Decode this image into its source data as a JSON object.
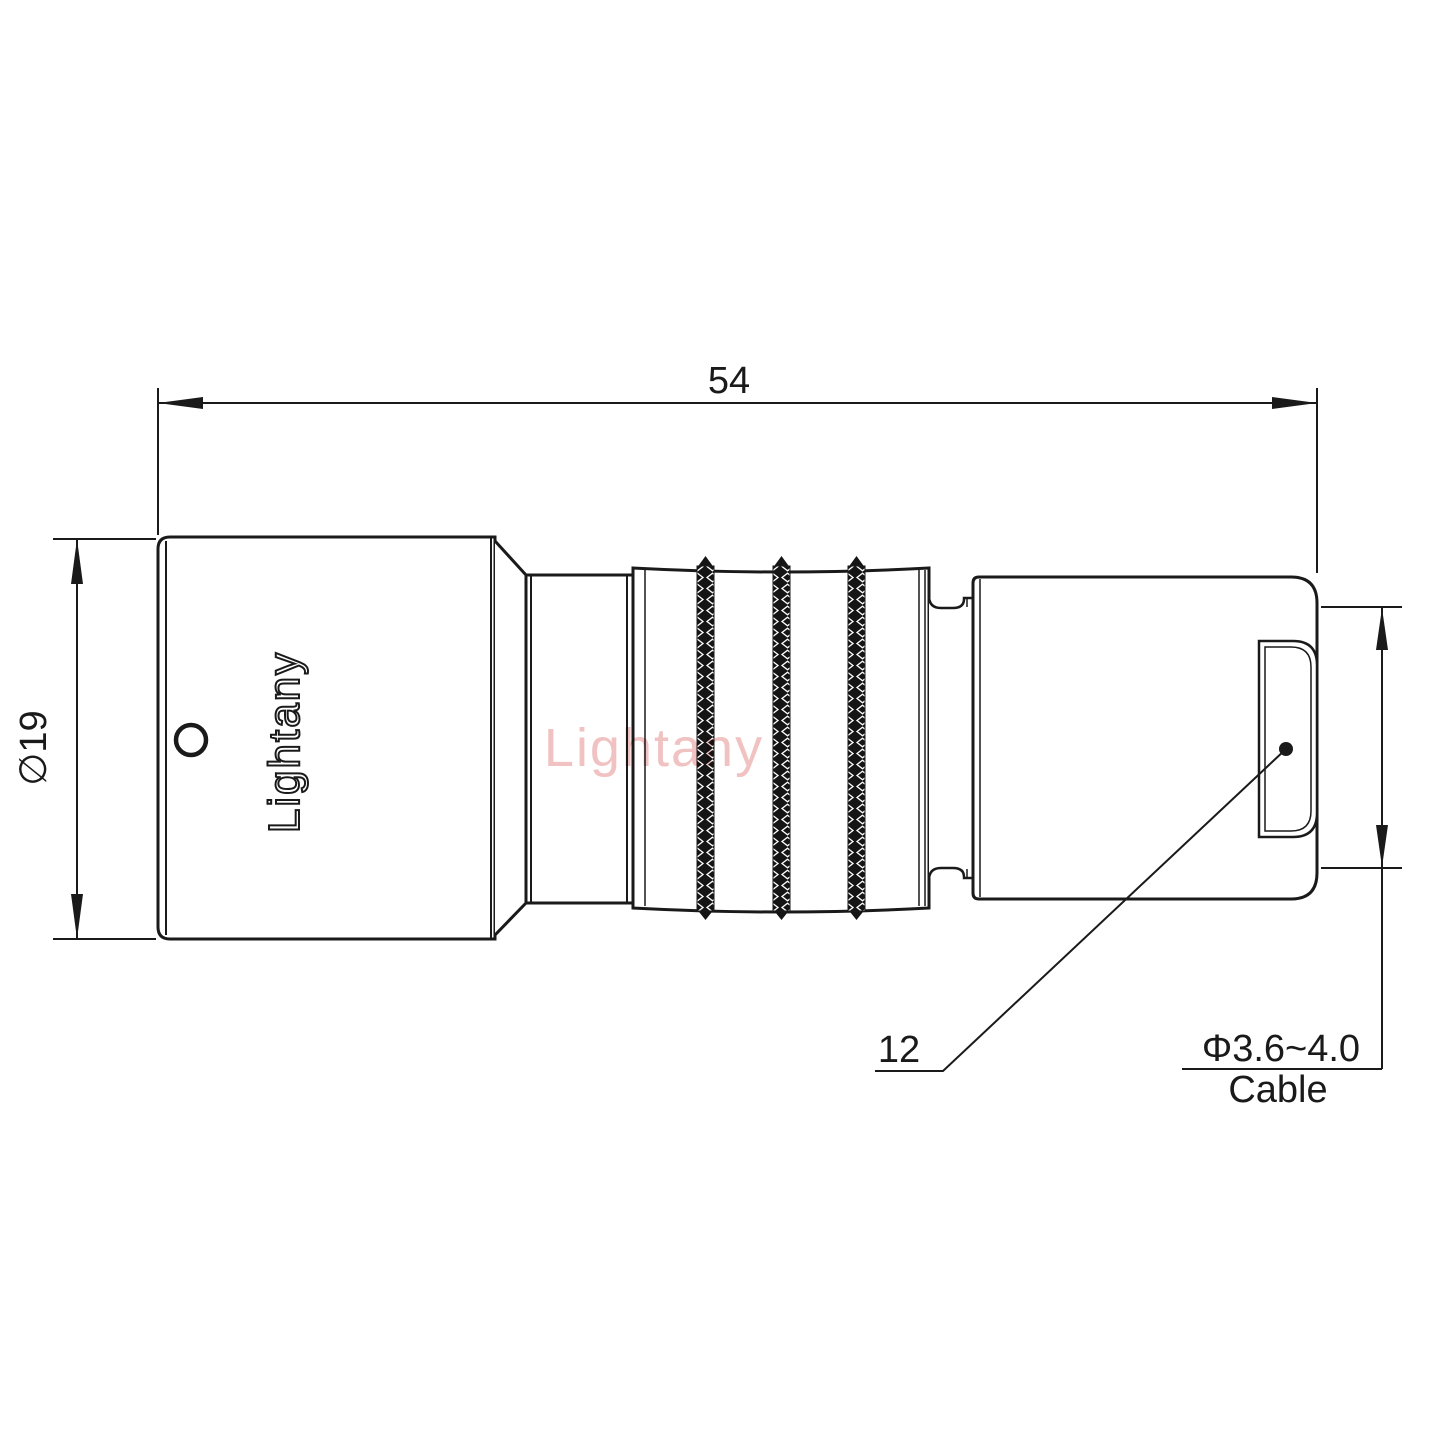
{
  "drawing": {
    "dimensions": {
      "overall_length": "54",
      "body_diameter": "∅19",
      "face_diameter": "12",
      "cable_diameter_range": "Φ3.6~4.0",
      "cable_label": "Cable"
    },
    "branding": {
      "engraving": "Lightany",
      "watermark": "Lightany"
    },
    "colors": {
      "line": "#1a1a1a",
      "watermark_pink": "#f1c2c2",
      "background": "#ffffff"
    }
  }
}
